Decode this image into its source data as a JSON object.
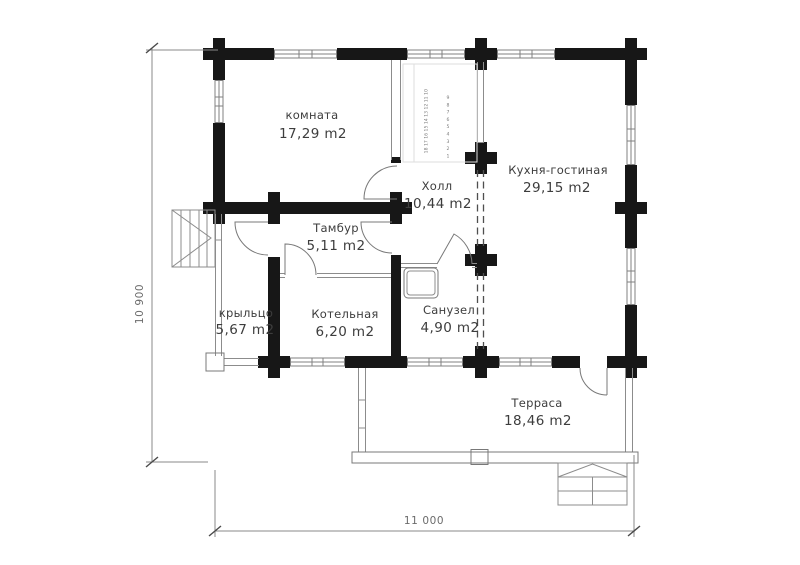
{
  "rooms": [
    {
      "name": "комната",
      "area": "17,29 m2"
    },
    {
      "name": "Холл",
      "area": "10,44 m2"
    },
    {
      "name": "Кухня-гостиная",
      "area": "29,15 m2"
    },
    {
      "name": "Тамбур",
      "area": "5,11 m2"
    },
    {
      "name": "крыльцо",
      "area": "5,67 m2"
    },
    {
      "name": "Котельная",
      "area": "6,20 m2"
    },
    {
      "name": "Санузел",
      "area": "4,90 m2"
    },
    {
      "name": "Терраса",
      "area": "18,46 m2"
    }
  ],
  "dimensions": {
    "horizontal": "11 000",
    "vertical": "10 900"
  },
  "stairs": {
    "upper_flight_steps": [
      "10",
      "11",
      "12",
      "13",
      "14",
      "15",
      "16",
      "17",
      "18"
    ],
    "lower_flight_steps": [
      "9",
      "8",
      "7",
      "6",
      "5",
      "4",
      "3",
      "2",
      "1"
    ]
  },
  "colors": {
    "wall": "#171717",
    "thin_line": "#8c8c8c",
    "text": "#3d3d3d",
    "dimension": "#6b6b6b"
  }
}
